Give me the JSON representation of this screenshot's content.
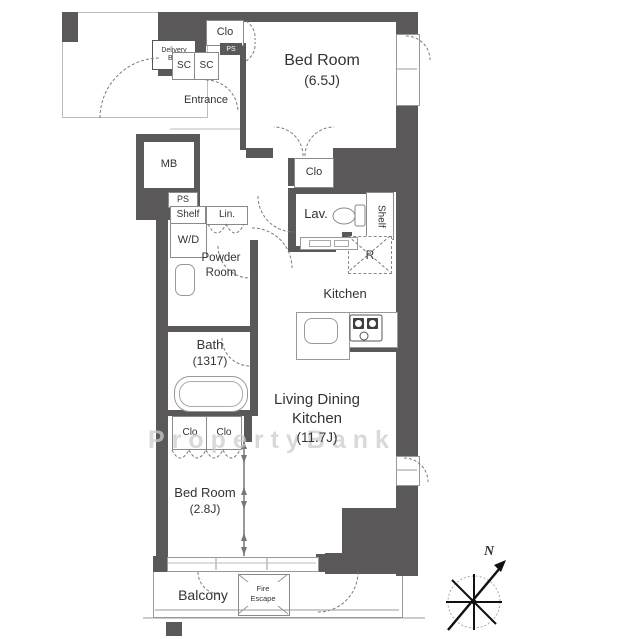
{
  "colors": {
    "wall": "#5a5858",
    "line": "#9a9a9a",
    "text": "#333333",
    "watermark": "#cdcdcd"
  },
  "watermark_text": "PropertyBank",
  "compass": {
    "north_label": "N"
  },
  "rooms": {
    "bedroom_top": {
      "name": "Bed Room",
      "size": "(6.5J)"
    },
    "bedroom_bottom": {
      "name": "Bed Room",
      "size": "(2.8J)"
    },
    "ldk": {
      "line1": "Living Dining",
      "line2": "Kitchen",
      "size": "(11.7J)"
    },
    "kitchen": {
      "name": "Kitchen"
    },
    "bath": {
      "name": "Bath",
      "size": "(1317)"
    },
    "powder": {
      "line1": "Powder",
      "line2": "Room"
    },
    "lavatory": {
      "name": "Lav."
    },
    "entrance": {
      "name": "Entrance"
    },
    "balcony": {
      "name": "Balcony"
    }
  },
  "labels": {
    "delivery_line1": "Delivery",
    "delivery_line2": "Box",
    "clo_top": "Clo",
    "clo_mid": "Clo",
    "clo_left": "Clo",
    "clo_right": "Clo",
    "sc_left": "SC",
    "sc_right": "SC",
    "ps_small": "PS",
    "ps": "PS",
    "mb": "MB",
    "shelf_top": "Shelf",
    "shelf_side": "Shelf",
    "wd": "W/D",
    "linen": "Lin.",
    "refrigerator": "R",
    "fire_line1": "Fire",
    "fire_line2": "Escape"
  }
}
